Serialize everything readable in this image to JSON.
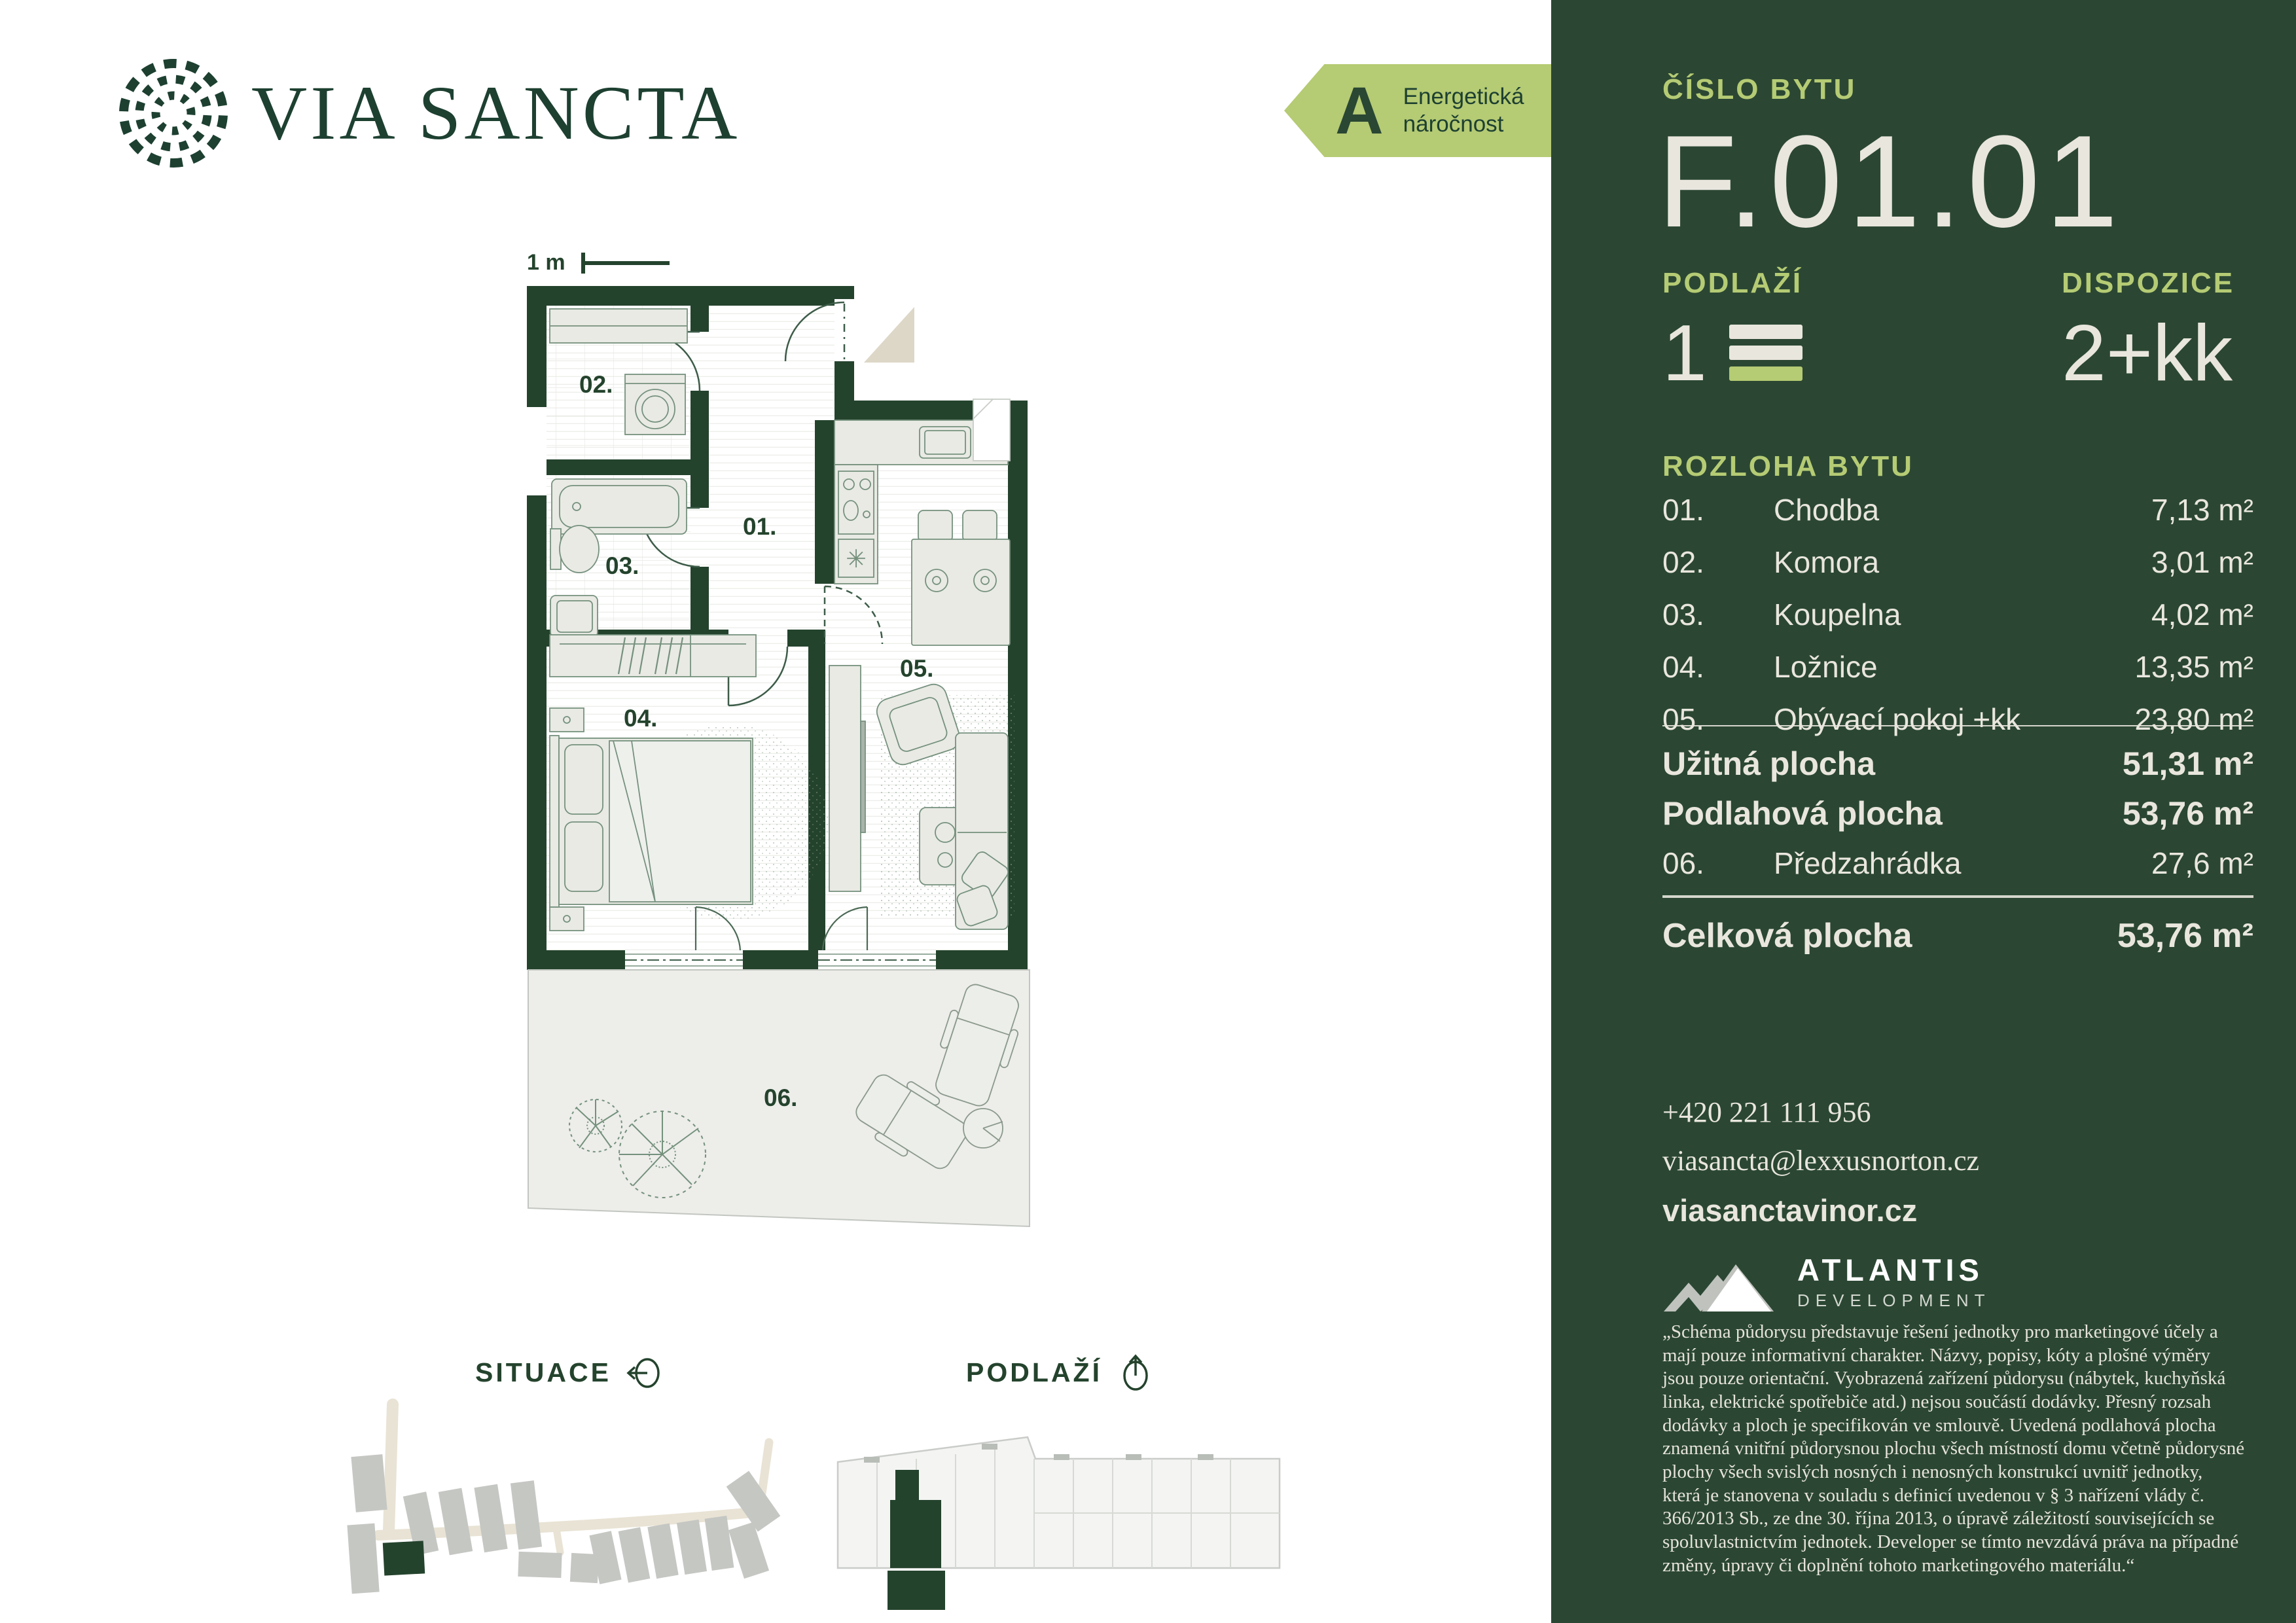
{
  "brand": {
    "via": "VIA",
    "sancta": "SANCTA"
  },
  "energy": {
    "grade": "A",
    "line1": "Energetická",
    "line2": "náročnost"
  },
  "panel": {
    "unit_label": "ČÍSLO BYTU",
    "unit_number": "F.01.01",
    "floor_label": "PODLAŽÍ",
    "floor_value": "1",
    "layout_label": "DISPOZICE",
    "layout_value": "2+kk",
    "area_label": "ROZLOHA BYTU",
    "rooms": [
      {
        "num": "01.",
        "name": "Chodba",
        "area": "7,13 m²"
      },
      {
        "num": "02.",
        "name": "Komora",
        "area": "3,01 m²"
      },
      {
        "num": "03.",
        "name": "Koupelna",
        "area": "4,02 m²"
      },
      {
        "num": "04.",
        "name": "Ložnice",
        "area": "13,35 m²"
      },
      {
        "num": "05.",
        "name": "Obývací pokoj +kk",
        "area": "23,80 m²"
      }
    ],
    "usable_label": "Užitná plocha",
    "usable_value": "51,31 m²",
    "floorarea_label": "Podlahová plocha",
    "floorarea_value": "53,76 m²",
    "garden_num": "06.",
    "garden_label": "Předzahrádka",
    "garden_value": "27,6 m²",
    "total_label": "Celková plocha",
    "total_value": "53,76 m²",
    "phone": "+420 221 111 956",
    "email": "viasancta@lexxusnorton.cz",
    "web": "viasanctavinor.cz",
    "developer_name": "ATLANTIS",
    "developer_sub": "DEVELOPMENT",
    "disclaimer": "„Schéma půdorysu představuje řešení jednotky pro marketingové účely a mají pouze informativní charakter. Názvy, popisy, kóty a plošné výměry jsou pouze orientační. Vyobrazená zařízení půdorysu (nábytek, kuchyňská linka, elektrické spotřebiče atd.) nejsou součástí dodávky. Přesný rozsah dodávky a ploch je specifikován ve smlouvě. Uvedená podlahová plocha znamená vnitřní půdorysnou plochu všech místností domu včetně půdorysné plochy všech svislých nosných i nenosných konstrukcí uvnitř jednotky, která je stanovena v souladu s definicí uvedenou v § 3 nařízení vlády č. 366/2013 Sb., ze dne 30. října 2013, o úpravě záležitostí souvisejících se spoluvlastnictvím jednotek. Developer se tímto nevzdává práva na případné změny, úpravy či doplnění tohoto marketingového materiálu.“"
  },
  "plan": {
    "scale_label": "1 m",
    "room_labels": {
      "r1": "01.",
      "r2": "02.",
      "r3": "03.",
      "r4": "04.",
      "r5": "05.",
      "r6": "06."
    }
  },
  "footer": {
    "situace_label": "SITUACE",
    "podlazi_label": "PODLAŽÍ"
  },
  "colors": {
    "panel_green": "#2b4733",
    "wall_green": "#24432d",
    "lime": "#b5cb74",
    "cream": "#e9e6de"
  }
}
